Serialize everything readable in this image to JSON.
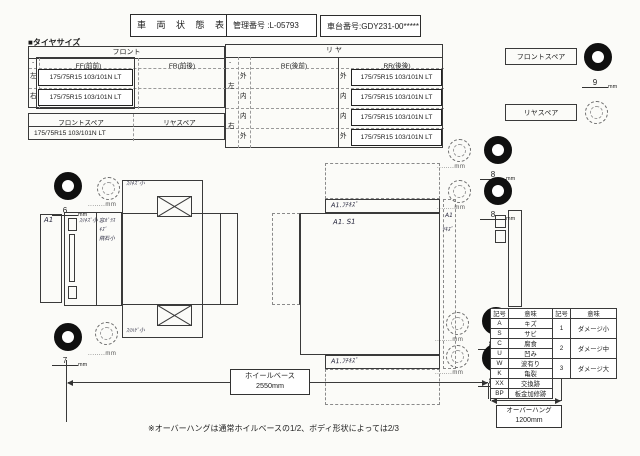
{
  "header": {
    "title": "車 両 状 態 表",
    "control_no": "管理番号 :L-05793",
    "chassis_no": "車台番号:GDY231-00*****"
  },
  "tire_section": {
    "label": "■タイヤサイズ",
    "front": {
      "title": "フロント",
      "stub": "-",
      "ff_header": "FF(前前)",
      "fr_header": "FR(前後)",
      "left": "左",
      "right": "右",
      "left_value": "175/75R15 103/101N LT",
      "right_value": "175/75R15 103/101N LT"
    },
    "rear": {
      "title": "リ ヤ",
      "stub": "-",
      "rf_header": "RF(後前)",
      "rr_header": "RR(後後)",
      "left": "左",
      "right": "右",
      "rows": [
        {
          "io": "外",
          "value": "175/75R15 103/101N LT"
        },
        {
          "io": "内",
          "value": "175/75R15 103/101N LT"
        },
        {
          "io": "内",
          "value": "175/75R15 103/101N LT"
        },
        {
          "io": "外",
          "value": "175/75R15 103/101N LT"
        }
      ]
    },
    "spare": {
      "front_header": "フロントスペア",
      "rear_header": "リヤスペア",
      "front_value": "175/75R15 103/101N LT"
    }
  },
  "spare_panels": {
    "front_label": "フロントスペア",
    "rear_label": "リヤスペア",
    "front_depth": "9"
  },
  "tread": {
    "unit": "mm",
    "dots": "........",
    "front_top": "6",
    "front_bottom": "7",
    "rear_values": [
      "8",
      "8",
      "8",
      "8"
    ]
  },
  "annotations": {
    "bumper": "A1",
    "cab_window": "ｽﾘｷｽﾞ小",
    "glass_line1": "窓ｶﾞﾗｽ",
    "glass_line2": "ｷｽﾞ",
    "glass_line3": "飛石小",
    "bed_top": "ｽﾘｷｽﾞ小",
    "bed_bottom": "ｽﾘﾊｹﾞ小",
    "cargo_top_rail": "A1.ﾌﾁｷｽﾞ",
    "cargo_floor": "A1. S1",
    "cargo_bottom_rail": "A1.ﾌﾁｷｽﾞ",
    "gate_line1": "A1",
    "gate_line2": "ﾂｷｽﾞ"
  },
  "measurements": {
    "wheelbase_label": "ホイールベース",
    "wheelbase_value": "2550mm",
    "overhang_label": "オーバーハング",
    "overhang_value": "1200mm",
    "note": "※オーバーハングは通常ホイルベースの1/2、ボディ形状によっては2/3"
  },
  "legend": {
    "col_code": "記号",
    "col_meaning": "意味",
    "rows": [
      {
        "code": "A",
        "meaning": "キズ"
      },
      {
        "code": "S",
        "meaning": "サビ"
      },
      {
        "code": "C",
        "meaning": "腐食"
      },
      {
        "code": "U",
        "meaning": "凹み"
      },
      {
        "code": "W",
        "meaning": "波有り"
      },
      {
        "code": "K",
        "meaning": "亀裂"
      },
      {
        "code": "XX",
        "meaning": "交換跡"
      },
      {
        "code": "BP",
        "meaning": "板金加修跡"
      }
    ],
    "damage": [
      {
        "code": "1",
        "meaning": "ダメージ小"
      },
      {
        "code": "2",
        "meaning": "ダメージ中"
      },
      {
        "code": "3",
        "meaning": "ダメージ大"
      }
    ]
  }
}
